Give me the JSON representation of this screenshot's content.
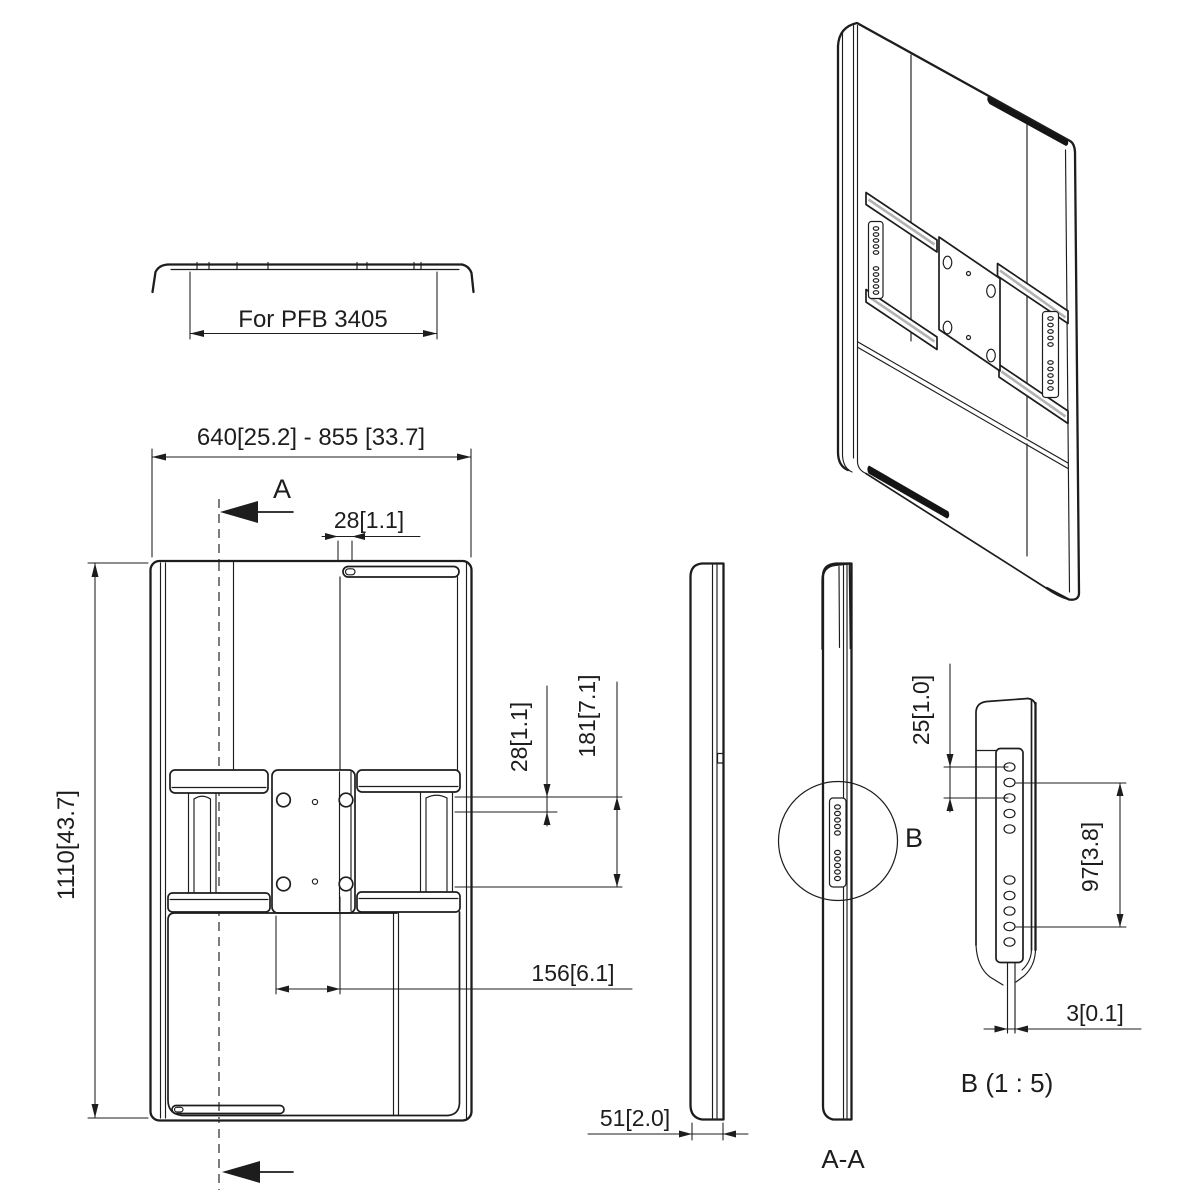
{
  "drawing": {
    "type": "technical-dimension-drawing",
    "line_color": "#1d1d1d",
    "background_color": "#ffffff",
    "rail_stripe_color": "#b3b3b3"
  },
  "top_view": {
    "dim_label": "For PFB 3405"
  },
  "front_view": {
    "dim_width_range": "640[25.2] - 855 [33.7]",
    "dim_height": "1110[43.7]",
    "dim_slot_offset": "28[1.1]",
    "dim_hole_offset": "28[1.1]",
    "dim_hole_span_vertical": "181[7.1]",
    "dim_hole_span_horizontal": "156[6.1]",
    "section_arrow_label": "A"
  },
  "side_views": {
    "dim_depth": "51[2.0]",
    "section_title": "A-A",
    "detail_marker_label": "B"
  },
  "detail_view": {
    "title": "B (1 : 5)",
    "dim_hole_pitch": "25[1.0]",
    "dim_hole_group_span": "97[3.8]",
    "dim_plate_thickness": "3[0.1]"
  }
}
